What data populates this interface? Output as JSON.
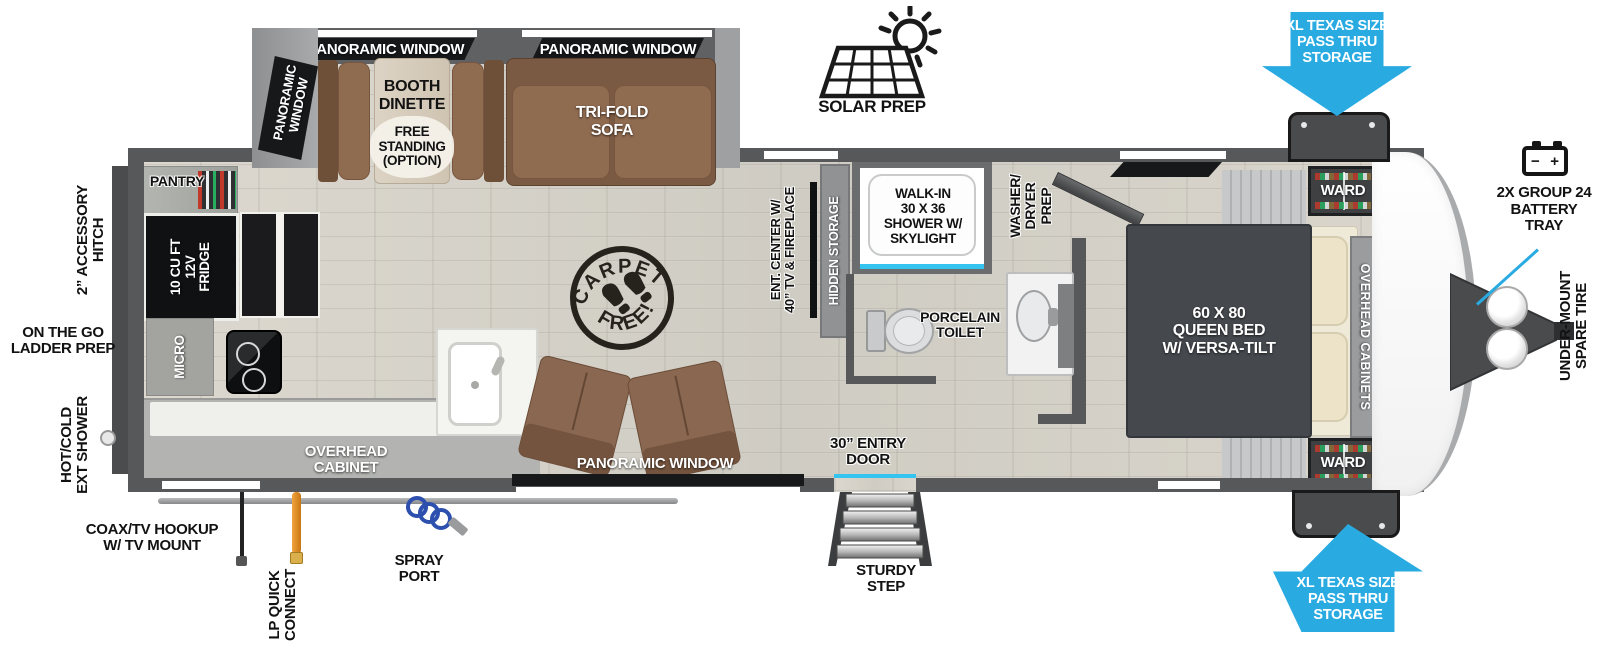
{
  "title": "Travel trailer floor plan",
  "colors": {
    "arrow_blue": "#29abe2",
    "accent_cyan": "#35c4f0",
    "wall_gray": "#57585a",
    "furniture_brown": "#8f6b50",
    "bed_gray": "#45494e",
    "lp_orange": "#e08b26",
    "spray_blue": "#2d4fae"
  },
  "icons": {
    "solar_prep": "sun-over-solar-panel-icon",
    "battery": "battery-terminals-icon",
    "carpet_free": "boot-prints-stamp-icon",
    "steps": "entry-steps-icon",
    "propane_tanks": "dual-propane-tanks-icon"
  },
  "labels": {
    "pano_top_1": "PANORAMIC WINDOW",
    "pano_top_2": "PANORAMIC WINDOW",
    "pano_side": "PANORAMIC WINDOW",
    "pano_bottom": "PANORAMIC WINDOW",
    "booth": "BOOTH\nDINETTE",
    "booth_opt": "FREE\nSTANDING\n(OPTION)",
    "sofa": "TRI-FOLD\nSOFA",
    "solar": "SOLAR PREP",
    "passthru_top": "XL TEXAS SIZE\nPASS THRU\nSTORAGE",
    "passthru_bottom": "XL TEXAS SIZE\nPASS THRU\nSTORAGE",
    "battery": "2X GROUP 24\nBATTERY\nTRAY",
    "battery_minus": "−",
    "battery_plus": "+",
    "spare": "UNDER-MOUNT\nSPARE TIRE",
    "ward_top": "WARD",
    "ward_bottom": "WARD",
    "overhead_cabs": "OVERHEAD CABINETS",
    "bed": "60 X 80\nQUEEN BED\nW/ VERSA-TILT",
    "wd_prep": "WASHER/\nDRYER\nPREP",
    "shower": "WALK-IN\n30 X 36\nSHOWER W/\nSKYLIGHT",
    "toilet": "PORCELAIN\nTOILET",
    "hidden": "HIDDEN STORAGE",
    "ent": "ENT. CENTER W/\n40” TV & FIREPLACE",
    "stamp_top": "CARPET",
    "stamp_bottom": "FREE!",
    "pantry": "PANTRY",
    "fridge": "10 CU FT\n12V\nFRIDGE",
    "micro": "MICRO",
    "oh_cab": "OVERHEAD\nCABINET",
    "entry": "30” ENTRY\nDOOR",
    "step": "STURDY\nSTEP",
    "hitch": "2” ACCESSORY\nHITCH",
    "ladder": "ON THE GO\nLADDER PREP",
    "extshower": "HOT/COLD\nEXT SHOWER",
    "coax": "COAX/TV HOOKUP\nW/ TV MOUNT",
    "lp": "LP QUICK\nCONNECT",
    "spray": "SPRAY\nPORT"
  }
}
